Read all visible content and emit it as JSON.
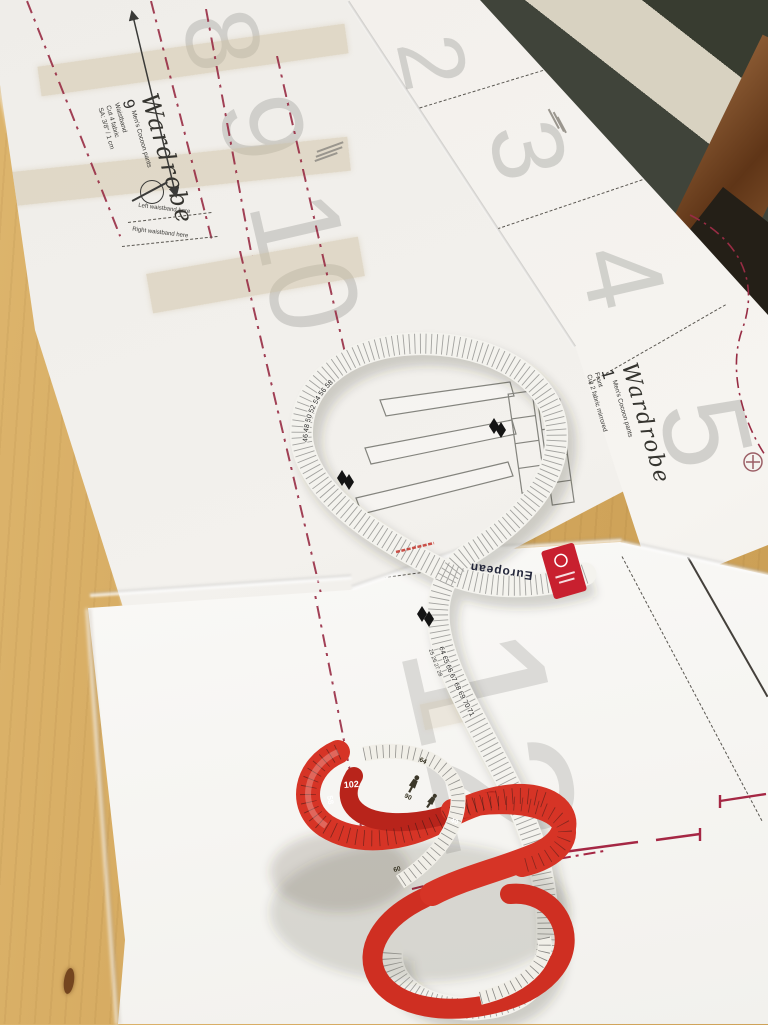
{
  "sheets": {
    "a": {
      "brand": "Wardrobe",
      "piece_numbers": [
        "8",
        "9",
        "10"
      ],
      "label": {
        "number": "9",
        "name": "Men's Cocoon pants",
        "piece": "Waistband",
        "cut": "Cut 4 fabric",
        "sa": "SA: 3/8\" / 1 cm"
      },
      "notes": {
        "left": "Left waistband here",
        "right": "Right waistband here"
      }
    },
    "b": {
      "brand": "Wardrobe",
      "piece_numbers": [
        "2",
        "3",
        "4",
        "5"
      ],
      "label": {
        "number": "1",
        "name": "Men's Cocoon pants",
        "piece": "Front",
        "cut": "Cut 2 fabric mirrored",
        "sa": "SA: 3/8\" / 1 cm",
        "hem": "Hem 1\" / 2,2 cm"
      }
    },
    "c": {
      "piece_numbers": [
        "12"
      ]
    }
  },
  "tape_white": {
    "brand_text": "European",
    "cm_run": "64    65    66    67    68    69    70    71",
    "in_run": "25      26      27      28",
    "cm_loop": "46    48    50    52    54    56    58"
  },
  "tape_red": {
    "numbers": {
      "n102": "102",
      "n58": "58",
      "n90": "90",
      "n64": "64",
      "n60": "60",
      "n40": "40"
    }
  },
  "colors": {
    "accent_red": "#c8202f",
    "pattern_red": "#982c44",
    "tape_red": "#d63426",
    "wood": "#d9af63",
    "door_frame": "#d8d2c1",
    "door_glass": "#454a3d"
  }
}
